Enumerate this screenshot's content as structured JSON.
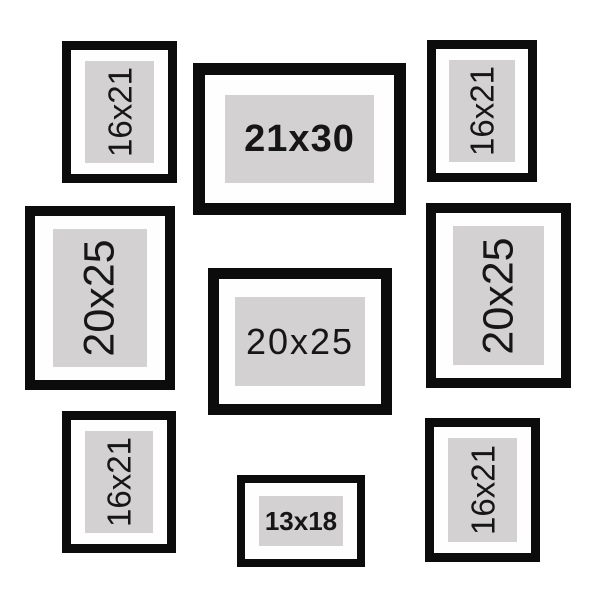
{
  "colors": {
    "frame_border": "#0c0c0c",
    "mat": "#fefefe",
    "photo_placeholder": "#d3d1d1",
    "label_text": "#161616",
    "background": "#ffffff"
  },
  "frames": [
    {
      "position": "top-left",
      "size_label": "16x21",
      "orientation": "portrait"
    },
    {
      "position": "top-center",
      "size_label": "21x30",
      "orientation": "landscape"
    },
    {
      "position": "top-right",
      "size_label": "16x21",
      "orientation": "portrait"
    },
    {
      "position": "middle-left",
      "size_label": "20x25",
      "orientation": "portrait"
    },
    {
      "position": "middle-center",
      "size_label": "20x25",
      "orientation": "landscape"
    },
    {
      "position": "middle-right",
      "size_label": "20x25",
      "orientation": "portrait"
    },
    {
      "position": "bottom-left",
      "size_label": "16x21",
      "orientation": "portrait"
    },
    {
      "position": "bottom-center",
      "size_label": "13x18",
      "orientation": "landscape"
    },
    {
      "position": "bottom-right",
      "size_label": "16x21",
      "orientation": "portrait"
    }
  ]
}
